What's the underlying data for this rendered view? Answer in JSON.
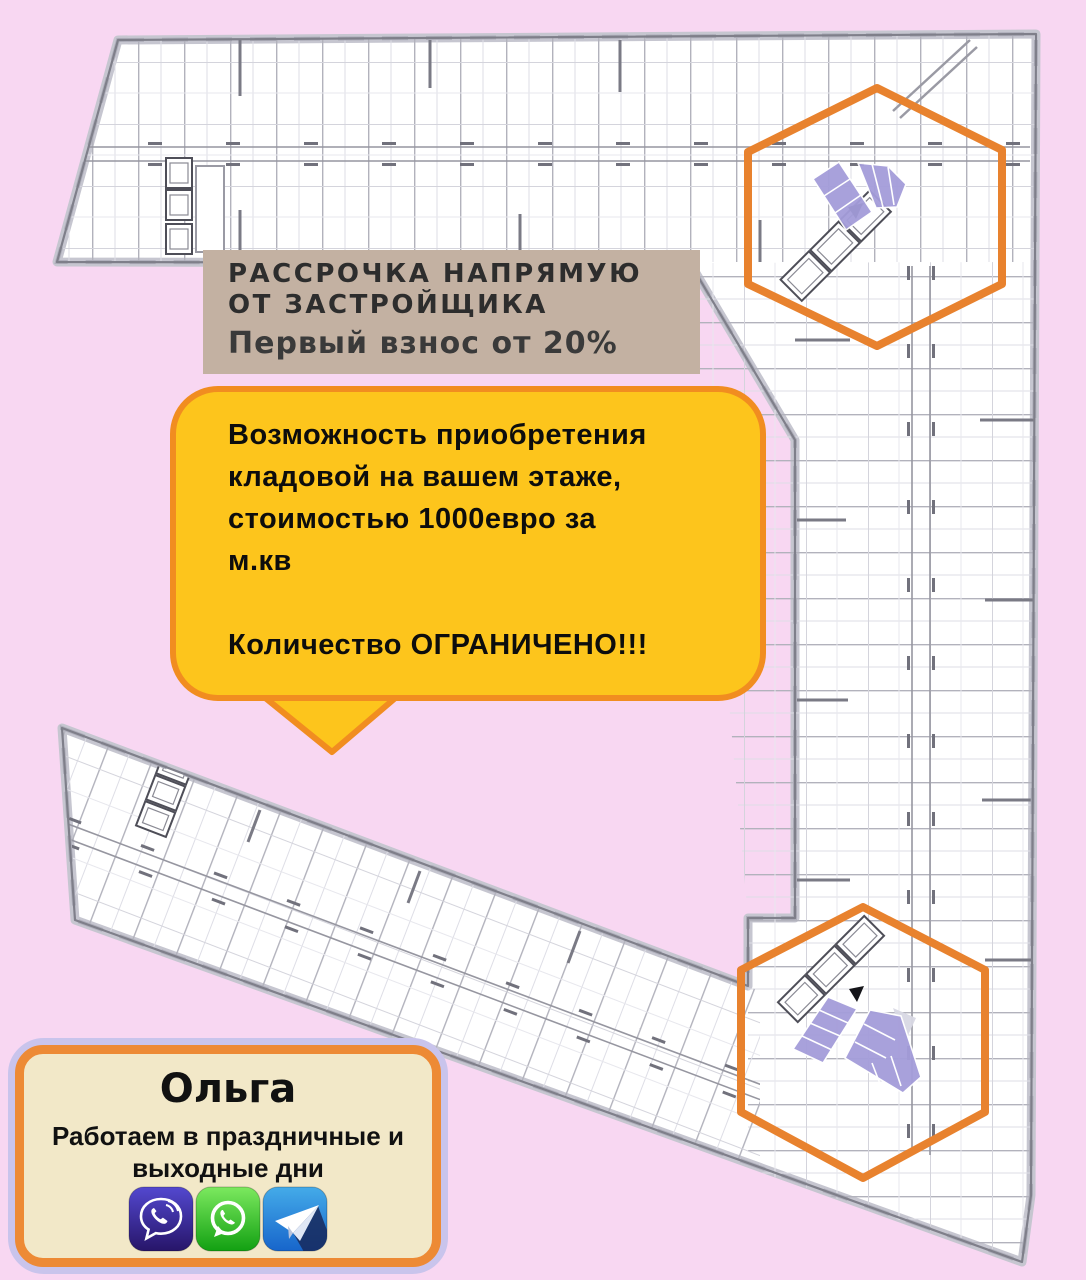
{
  "banner": {
    "line1": "РАССРОЧКА НАПРЯМУЮ",
    "line2": "ОТ ЗАСТРОЙЩИКА",
    "line3": "Первый взнос от 20%",
    "bg_color": "#c3b1a2",
    "text_color": "#2d2d2d"
  },
  "bubble": {
    "lines": [
      "Возможность приобретения",
      "кладовой на вашем этаже,",
      "стоимостью 1000евро за",
      "м.кв"
    ],
    "emphasis": "Количество ОГРАНИЧЕНО!!!",
    "bg_color": "#fdc51c",
    "border_color": "#f18d20"
  },
  "contact_card": {
    "name": "Ольга",
    "note_line1": "Работаем в праздничные и",
    "note_line2": "выходные дни",
    "messengers": [
      {
        "icon": "viber-icon",
        "color": "#3b2ba8"
      },
      {
        "icon": "whatsapp-icon",
        "color": "#1faa1f"
      },
      {
        "icon": "telegram-icon",
        "color": "#2b87d4"
      }
    ],
    "bg_color": "#f2e8c8",
    "border_orange": "#ed8a35",
    "border_lavender": "#c9c4ec"
  },
  "floor_plan": {
    "background_color": "#f8d7f2",
    "hexagon_color": "#e8822e",
    "storage_highlight_color": "#a49dda",
    "highlighted_zones": 2
  }
}
